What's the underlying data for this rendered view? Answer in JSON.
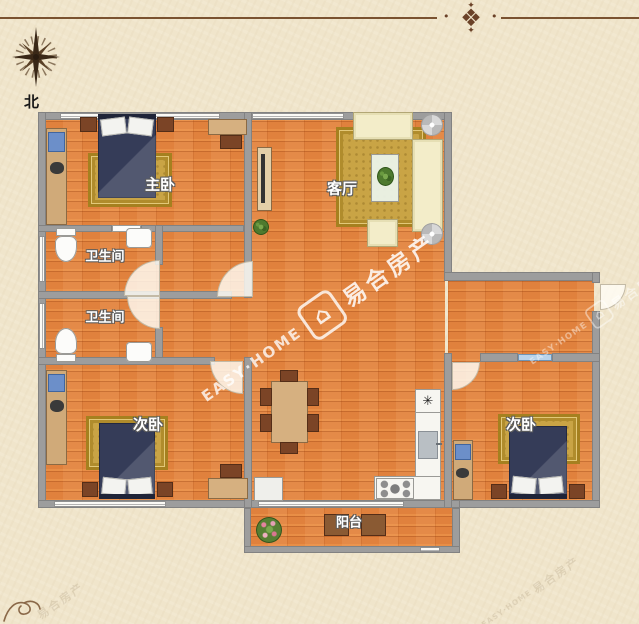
{
  "compass": {
    "label": "北"
  },
  "ornament": {
    "glyph": "❖",
    "spark": "✦",
    "dot": "•"
  },
  "rooms": {
    "master_bedroom": {
      "label": "主卧"
    },
    "bathroom_top": {
      "label": "卫生间"
    },
    "bathroom_bottom": {
      "label": "卫生间"
    },
    "bedroom_left": {
      "label": "次卧"
    },
    "living_room": {
      "label": "客厅"
    },
    "bedroom_right": {
      "label": "次卧"
    },
    "balcony": {
      "label": "阳台"
    }
  },
  "kitchen": {
    "fridge_glyph": "✳"
  },
  "watermark": {
    "cn": "易合房产",
    "en": "EASY·HOME",
    "logo_glyph": "⌂"
  },
  "palette": {
    "background": "#f0e5cb",
    "wall": "#9d9d9d",
    "floor_wood": "#e0813d",
    "bed_navy": "#353c58",
    "rug_gold": "#c9a445",
    "sofa_cream": "#f3edc9",
    "furniture_wood": "#d0aa79",
    "border_brown": "#7a5230",
    "window_blue": "#b9d3ea"
  }
}
